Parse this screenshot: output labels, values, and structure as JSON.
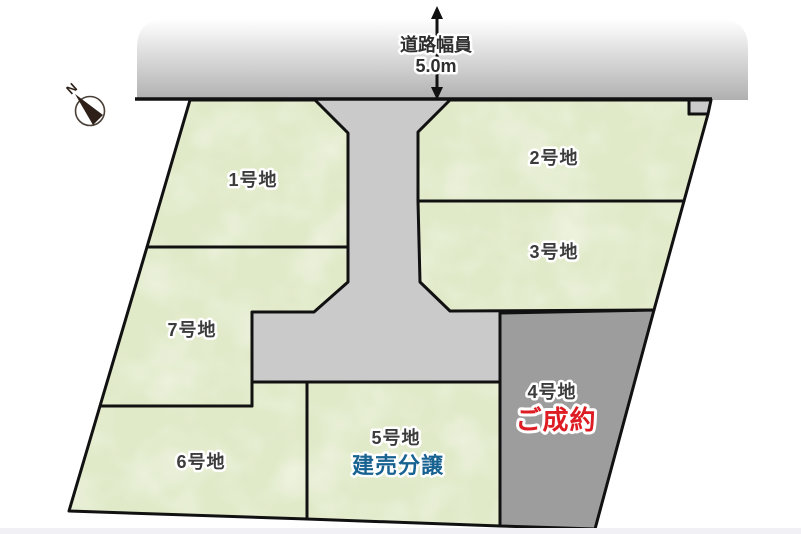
{
  "compass": {
    "north_label": "N"
  },
  "road_top": {
    "width_label": "道路幅員",
    "width_value": "5.0m"
  },
  "lots": {
    "lot1": {
      "label": "1号地"
    },
    "lot2": {
      "label": "2号地"
    },
    "lot3": {
      "label": "3号地"
    },
    "lot4": {
      "label": "4号地",
      "status": "ご成約"
    },
    "lot5": {
      "label": "5号地",
      "sale_type": "建売分譲"
    },
    "lot6": {
      "label": "6号地"
    },
    "lot7": {
      "label": "7号地"
    }
  },
  "colors": {
    "lot_green": "#e0e9c8",
    "road_gray": "#cacaca",
    "top_road_gradient_bottom": "#b0b0b0",
    "sold_lot_gray": "#9d9d9d",
    "label_dark": "#3c3c3c",
    "status_red": "#dd1c23",
    "sale_type_blue": "#176291",
    "outline_black": "#111111",
    "footer_strip": "#f1f0f4"
  }
}
